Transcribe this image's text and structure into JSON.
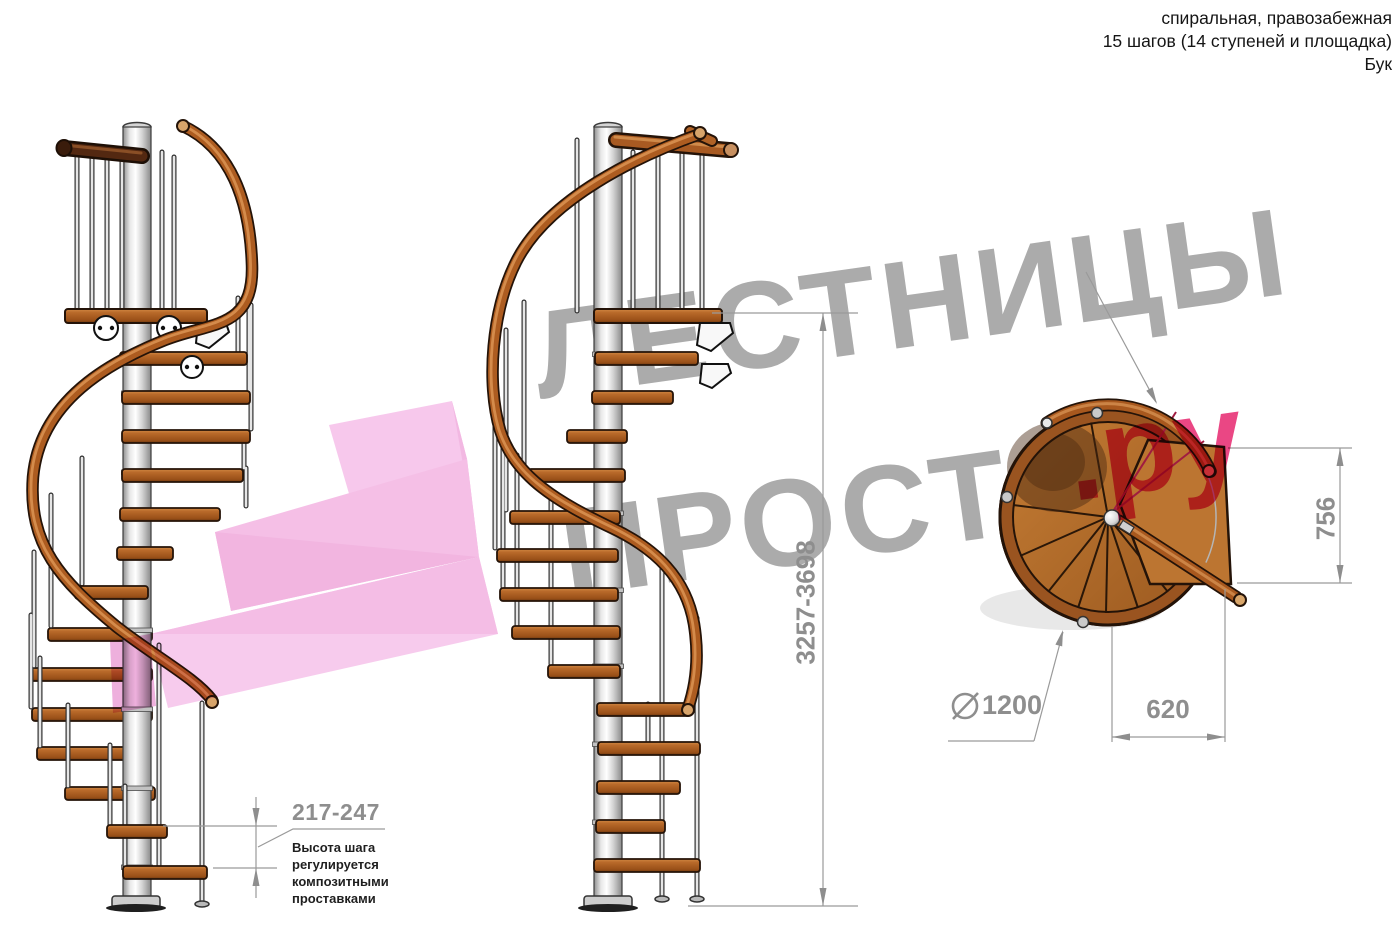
{
  "header": {
    "line1": "спиральная, правозабежная",
    "line2": "15 шагов (14 ступеней и площадка)",
    "line3": "Бук"
  },
  "watermark": {
    "line1": "ЛЕСТНИЦЫ",
    "line2": "ПРОСТО",
    "suffix": ".ру",
    "gray_color": "#ababab",
    "pink_color": "#ea4784"
  },
  "dimensions": {
    "total_height": "3257-3698",
    "step_height": "217-247",
    "step_note": "Высота шага\nрегулируется\nкомпозитными\nпроставками"
  },
  "plan": {
    "diameter_label": "1200",
    "width_label": "620",
    "depth_label": "756",
    "diameter_icon": "diameter-symbol"
  },
  "colors": {
    "wood": "#ad5c20",
    "wood_dark_outline": "#241308",
    "metal_pole": "#d9d9d9",
    "dimension_gray": "#8e8e8e",
    "accent_pink": "#ea4784",
    "watermark_gray": "#ababab",
    "plan_red_line": "#a01c40"
  }
}
